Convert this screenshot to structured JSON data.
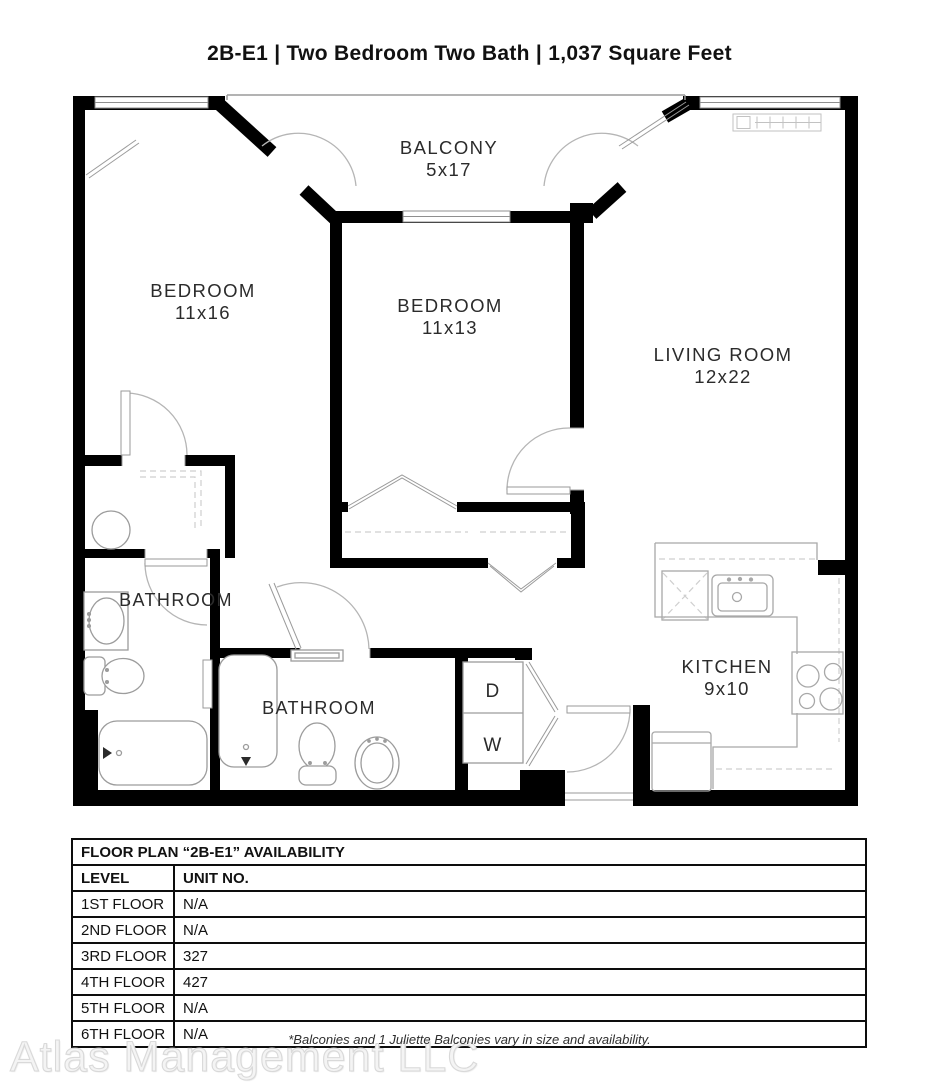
{
  "title": "2B-E1 | Two Bedroom Two Bath | 1,037 Square Feet",
  "floor_plan": {
    "rooms": [
      {
        "name": "BALCONY",
        "dims": "5x17"
      },
      {
        "name": "BEDROOM",
        "dims": "11x16"
      },
      {
        "name": "BEDROOM",
        "dims": "11x13"
      },
      {
        "name": "LIVING ROOM",
        "dims": "12x22"
      },
      {
        "name": "BATHROOM",
        "dims": ""
      },
      {
        "name": "BATHROOM",
        "dims": ""
      },
      {
        "name": "KITCHEN",
        "dims": "9x10"
      }
    ],
    "laundry": {
      "dryer_label": "D",
      "washer_label": "W"
    }
  },
  "availability_table": {
    "title": "FLOOR PLAN “2B-E1” AVAILABILITY",
    "columns": [
      "LEVEL",
      "UNIT NO."
    ],
    "rows": [
      [
        "1ST FLOOR",
        "N/A"
      ],
      [
        "2ND FLOOR",
        "N/A"
      ],
      [
        "3RD FLOOR",
        "327"
      ],
      [
        "4TH FLOOR",
        "427"
      ],
      [
        "5TH FLOOR",
        "N/A"
      ],
      [
        "6TH FLOOR",
        "N/A"
      ]
    ]
  },
  "footnote": "*Balconies and 1 Juliette Balconies vary in size and availability.",
  "watermark": "Atlas Management LLC",
  "colors": {
    "wall": "#000000",
    "fixture_line": "#9c9c9c",
    "dash_line": "#cfcfcf",
    "text": "#2b2b2b"
  }
}
